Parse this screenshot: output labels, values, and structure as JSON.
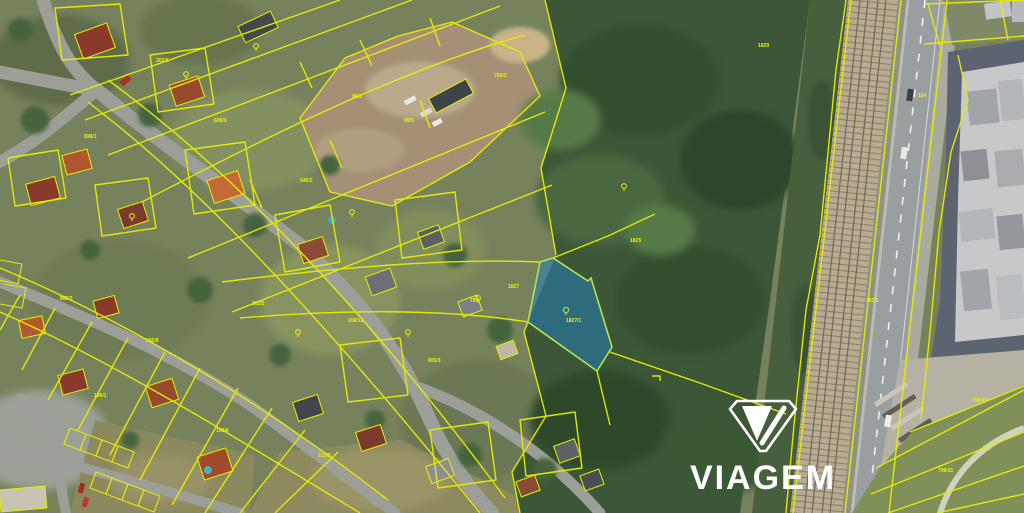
{
  "watermark": {
    "brand": "VIAGEM",
    "icon": "viagem-shield-logo",
    "color": "#ffffff"
  },
  "highlighted_parcel": {
    "fill": "#1f7fc4",
    "fill_opacity": "0.5",
    "stroke": "#b8e24e",
    "label": "1827/1",
    "land_use_icon": "circle-land-use-icon"
  },
  "cadastre": {
    "line_color": "#e8ee00",
    "label_color": "#ecf400",
    "labels": [
      {
        "t": "302/5",
        "x": 156,
        "y": 62
      },
      {
        "t": "599/1",
        "x": 84,
        "y": 138
      },
      {
        "t": "608/3",
        "x": 214,
        "y": 122
      },
      {
        "t": "302/2",
        "x": 252,
        "y": 305
      },
      {
        "t": "646/2",
        "x": 300,
        "y": 182
      },
      {
        "t": "208/12",
        "x": 348,
        "y": 322
      },
      {
        "t": "595/8",
        "x": 146,
        "y": 342
      },
      {
        "t": "186/1",
        "x": 94,
        "y": 397
      },
      {
        "t": "199/4",
        "x": 216,
        "y": 432
      },
      {
        "t": "213/5",
        "x": 318,
        "y": 457
      },
      {
        "t": "605/3",
        "x": 428,
        "y": 362
      },
      {
        "t": "787",
        "x": 470,
        "y": 302
      },
      {
        "t": "1827",
        "x": 508,
        "y": 288
      },
      {
        "t": "1827/1",
        "x": 566,
        "y": 322
      },
      {
        "t": "98/5",
        "x": 404,
        "y": 122
      },
      {
        "t": "760/2",
        "x": 494,
        "y": 77
      },
      {
        "t": "1825",
        "x": 630,
        "y": 242
      },
      {
        "t": "184",
        "x": 918,
        "y": 97
      },
      {
        "t": "183/1",
        "x": 866,
        "y": 302
      },
      {
        "t": "798/22",
        "x": 972,
        "y": 402
      },
      {
        "t": "798/31",
        "x": 938,
        "y": 472
      },
      {
        "t": "1829",
        "x": 758,
        "y": 47
      },
      {
        "t": "885/2",
        "x": 60,
        "y": 300
      },
      {
        "t": "96/1",
        "x": 352,
        "y": 98
      }
    ]
  },
  "land_use_icons": [
    {
      "x": 478,
      "y": 298
    },
    {
      "x": 352,
      "y": 212
    },
    {
      "x": 408,
      "y": 332
    },
    {
      "x": 298,
      "y": 332
    },
    {
      "x": 132,
      "y": 216
    },
    {
      "x": 624,
      "y": 186
    },
    {
      "x": 256,
      "y": 46
    },
    {
      "x": 186,
      "y": 74
    }
  ],
  "palette": {
    "residential_base": "#76825c",
    "forest": "#3c5737",
    "street": "#9b9f98",
    "railway_ballast": "#b7ab91",
    "highway": "#999ea0",
    "industrial_roof": "#c6c8ca",
    "grass": "#7f9158",
    "dirt": "#a59076"
  }
}
